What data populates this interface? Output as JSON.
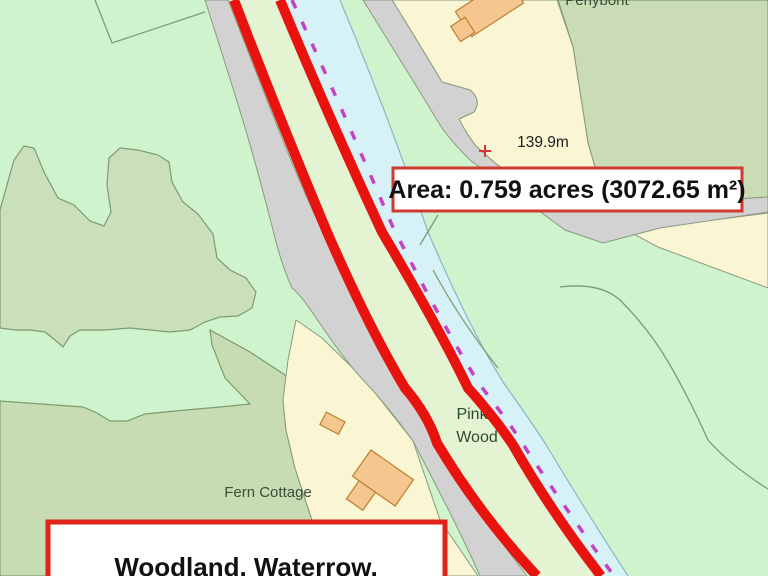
{
  "annotations": {
    "area_label": "Area: 0.759 acres (3072.65 m²)",
    "title_label": "Woodland, Waterrow,"
  },
  "map_labels": {
    "place_top": "Penybont",
    "spot_height": "139.9m",
    "wood_line1": "Pink",
    "wood_line2": "Wood",
    "cottage": "Fern Cottage"
  },
  "colors": {
    "boundary_red": "#e8120e",
    "footpath_magenta": "#c344c3",
    "river_cyan": "#d7f2f6",
    "road_grey": "#d2d2d2",
    "field_light_green": "#cff3cc",
    "field_sage_green": "#c9dcb6",
    "plot_strip_green": "#e4f4d3",
    "parcel_cream": "#faf6d4",
    "building_orange": "#f6c690",
    "annotation_border_red": "#d03a30",
    "annotation_fill": "#ffffff"
  }
}
